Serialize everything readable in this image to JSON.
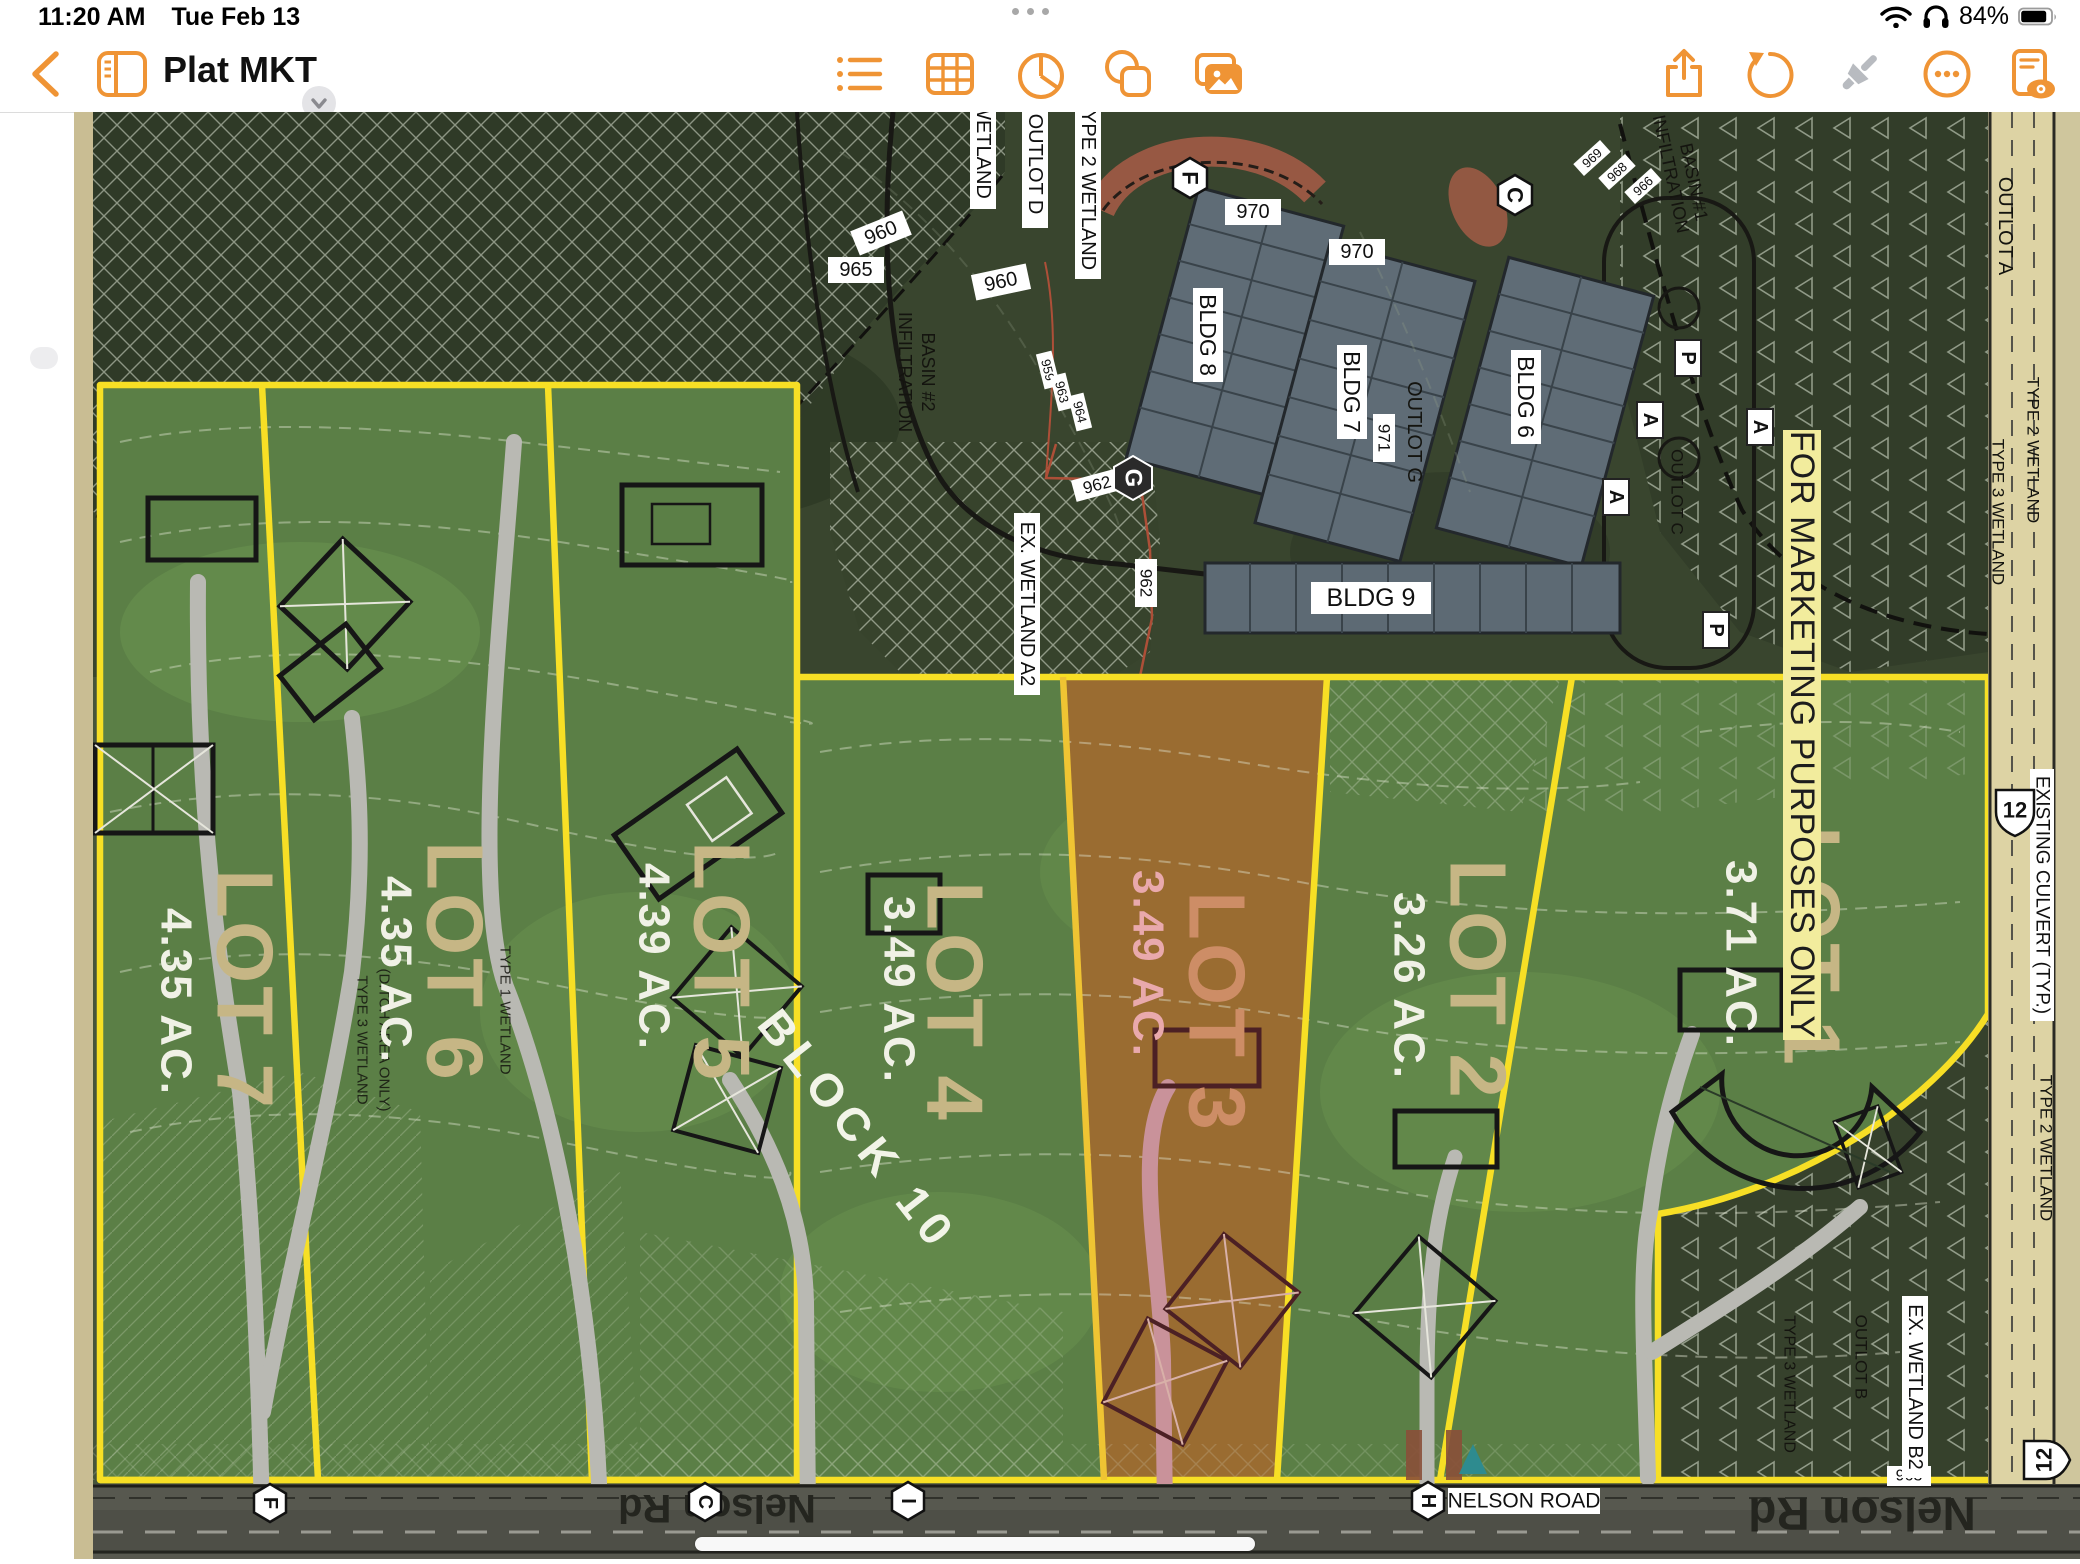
{
  "status_bar": {
    "time": "11:20 AM",
    "date": "Tue Feb 13",
    "battery_percent": "84%",
    "icons": [
      "wifi-icon",
      "headphones-icon",
      "battery-icon"
    ]
  },
  "toolbar": {
    "title": "Plat MKT",
    "accent_color": "#EF9435",
    "left_icons": [
      "back-icon",
      "sidebar-icon"
    ],
    "insert_icons": [
      "list-icon",
      "table-icon",
      "chart-icon",
      "shapes-icon",
      "media-icon"
    ],
    "right_icons": [
      "share-icon",
      "undo-icon",
      "format-brush-icon",
      "more-icon",
      "reading-view-icon"
    ]
  },
  "map": {
    "colors": {
      "lot_green": "#5b7f46",
      "lot3_orange": "#9a6c31",
      "boundary_yellow": "#f7df25",
      "banner_yellow": "#f2ec9d",
      "lot_name_tan": "#c6b685",
      "lot3_name_salmon": "#cd8d66",
      "lot3_acre_pink": "#e9a9ac"
    },
    "banner": "FOR MARKETING PURPOSES ONLY",
    "block_label": "BLOCK 10",
    "lots": [
      {
        "name": "LOT 7",
        "acreage": "4.35 AC."
      },
      {
        "name": "LOT 6",
        "acreage": "4.35 AC."
      },
      {
        "name": "LOT 5",
        "acreage": "4.39 AC."
      },
      {
        "name": "LOT 4",
        "acreage": "3.49 AC."
      },
      {
        "name": "LOT 3",
        "acreage": "3.49 AC."
      },
      {
        "name": "LOT 2",
        "acreage": "3.26 AC."
      },
      {
        "name": "LOT 1",
        "acreage": "3.71 AC."
      }
    ],
    "buildings": {
      "b6": "BLDG 6",
      "b7": "BLDG 7",
      "b8": "BLDG 8",
      "b9": "BLDG 9"
    },
    "labels": {
      "wetland": "WETLAND",
      "outlot_a": "OUTLOT A",
      "outlot_b": "OUTLOT B",
      "outlot_c": "OUTLOT C",
      "outlot_d": "OUTLOT D",
      "outlot_g": "OUTLOT G",
      "type2_wetland": "TYPE 2 WETLAND",
      "type3_wetland": "TYPE 3 WETLAND",
      "type1_wetland": "TYPE 1 WETLAND",
      "ditch_area": "(DITCH AREA ONLY)",
      "ex_wetland_a2": "EX. WETLAND A2",
      "ex_wetland_b2": "EX. WETLAND B2",
      "existing_culvert": "EXISTING CULVERT (TYP.)",
      "infiltration": "INFILTRATION",
      "basin1": "BASIN #1",
      "basin2": "BASIN #2",
      "nelson_road": "NELSON ROAD",
      "nelson_rd": "Nelson Rd",
      "route12": "12"
    },
    "elevations": {
      "e959": "959",
      "e960": "960",
      "e962": "962",
      "e963": "963",
      "e964": "964",
      "e965": "965",
      "e966": "966",
      "e968": "968",
      "e969": "969",
      "e970": "970",
      "e971": "971"
    },
    "markers": {
      "f": "F",
      "c": "C",
      "g": "G",
      "h": "H",
      "i": "I",
      "p": "P",
      "a": "A"
    }
  }
}
